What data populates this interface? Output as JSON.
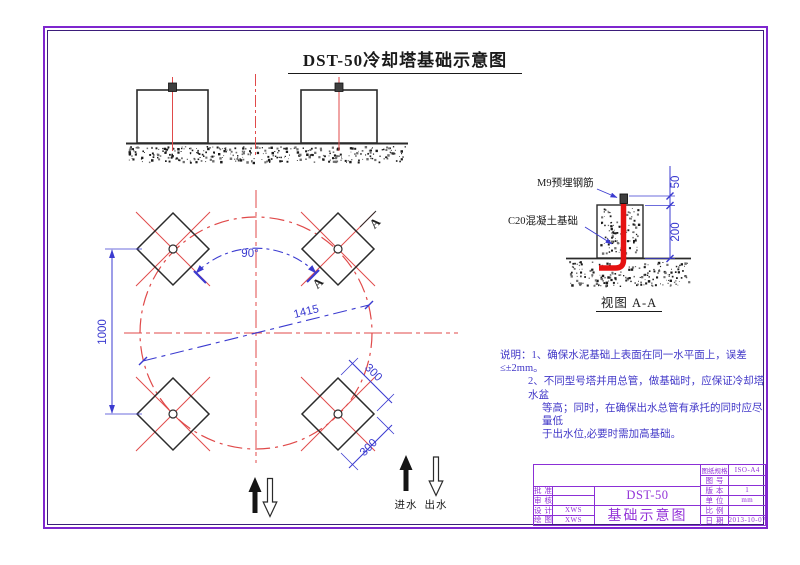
{
  "sheet": {
    "title": "DST-50冷却塔基础示意图"
  },
  "plan": {
    "dim_1000": "1000",
    "dim_90": "90°",
    "dim_1415": "1415",
    "dim_300a": "300",
    "dim_300b": "300",
    "section_a1": "A",
    "section_a2": "A"
  },
  "detail": {
    "rebar_label": "M9预埋钢筋",
    "concrete_label": "C20混凝土基础",
    "dim_50": "50",
    "dim_200": "200",
    "caption": "视图 A-A"
  },
  "flow": {
    "inlet": "进水",
    "outlet": "出水"
  },
  "notes": {
    "line1": "说明：1、确保水泥基础上表面在同一水平面上，误差≤±2mm。",
    "line2": "2、不同型号塔并用总管，做基础时，应保证冷却塔水盆",
    "line3": "等高；同时，在确保出水总管有承托的同时应尽量低",
    "line4": "于出水位,必要时需加高基础。"
  },
  "title_block": {
    "approve_label": "批准",
    "approve_value": "",
    "review_label": "审核",
    "review_value": "",
    "design_label": "设计",
    "design_value": "XWS",
    "draw_label": "绘图",
    "draw_value": "XWS",
    "model": "DST-50",
    "doc_title": "基础示意图",
    "spec_label": "图纸规格",
    "spec_value": "ISO-A4",
    "no_label": "图号",
    "no_value": "",
    "version_label": "版本",
    "version_value": "1",
    "unit_label": "单位",
    "unit_value": "mm",
    "scale_label": "比例",
    "scale_value": "",
    "date_label": "日期",
    "date_value": "2013-10-07"
  }
}
